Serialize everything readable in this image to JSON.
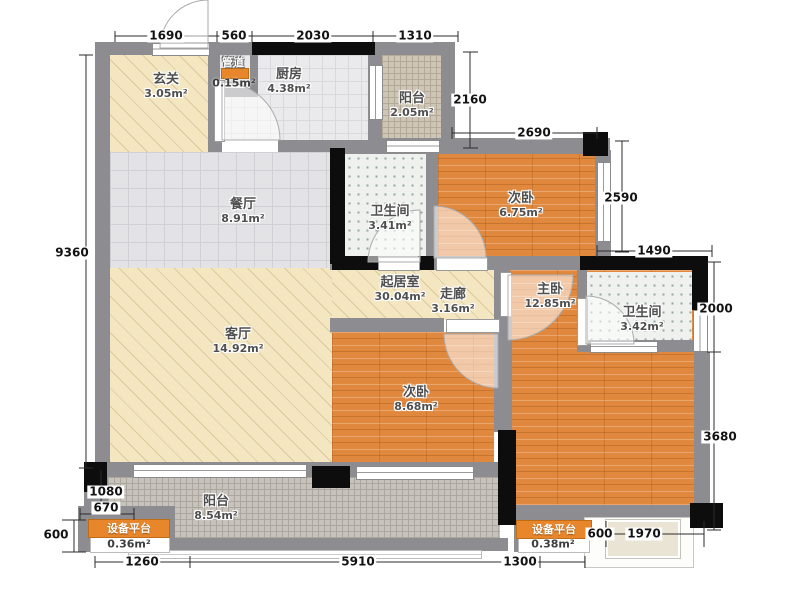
{
  "rooms": {
    "entry": {
      "name": "玄关",
      "area": "3.05m²"
    },
    "duct": {
      "name": "管道",
      "area": "0.15m²"
    },
    "kitchen": {
      "name": "厨房",
      "area": "4.38m²"
    },
    "balcony_top": {
      "name": "阳台",
      "area": "2.05m²"
    },
    "dining": {
      "name": "餐厅",
      "area": "8.91m²"
    },
    "bath1": {
      "name": "卫生间",
      "area": "3.41m²"
    },
    "bedroom1": {
      "name": "次卧",
      "area": "6.75m²"
    },
    "living_zone": {
      "name": "起居室",
      "area": "30.04m²"
    },
    "corridor": {
      "name": "走廊",
      "area": "3.16m²"
    },
    "master": {
      "name": "主卧",
      "area": "12.85m²"
    },
    "bath2": {
      "name": "卫生间",
      "area": "3.42m²"
    },
    "living": {
      "name": "客厅",
      "area": "14.92m²"
    },
    "bedroom2": {
      "name": "次卧",
      "area": "8.68m²"
    },
    "balcony_bottom": {
      "name": "阳台",
      "area": "8.54m²"
    },
    "platform_left": {
      "name": "设备平台",
      "area": "0.36m²"
    },
    "platform_right": {
      "name": "设备平台",
      "area": "0.38m²"
    }
  },
  "dimensions": {
    "top": [
      "1690",
      "560",
      "2030",
      "1310"
    ],
    "right": [
      "2160",
      "2690",
      "2590",
      "1490",
      "2000",
      "3680"
    ],
    "left": [
      "9360",
      "1080",
      "670",
      "600"
    ],
    "bottom": [
      "1260",
      "5910",
      "1300",
      "600",
      "1970"
    ]
  },
  "colors": {
    "wood": "#e0883e",
    "hatch_beige": "#f3e6c0",
    "tile_gray": "#e3e3e6",
    "wall_gray": "#8d8d91",
    "wall_black": "#0d0d0d",
    "accent_orange": "#e8862b"
  }
}
